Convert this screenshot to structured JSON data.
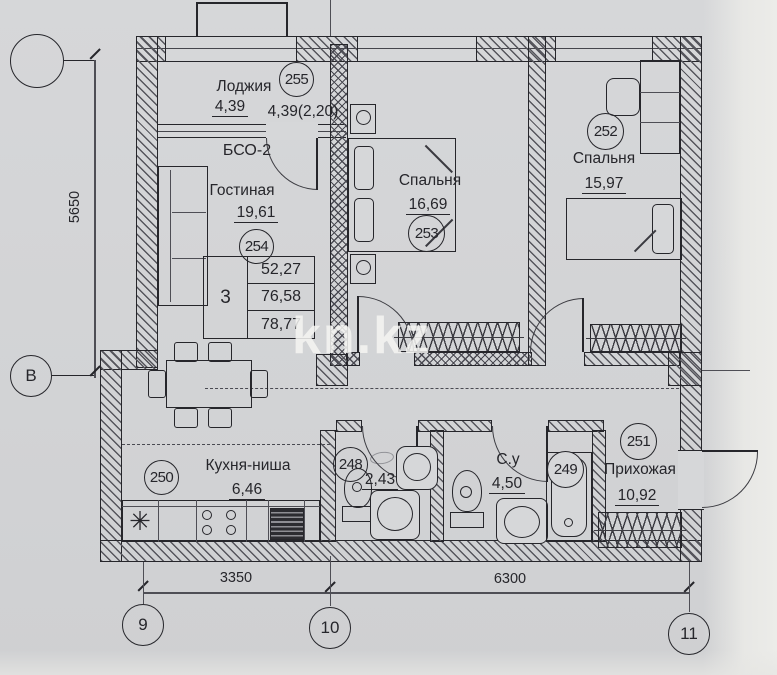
{
  "watermark": "kn.kz",
  "axes": {
    "b": "В",
    "c9": "9",
    "c10": "10",
    "c11": "11"
  },
  "dims": {
    "v": "5650",
    "b1": "3350",
    "b2": "6300"
  },
  "rooms": {
    "loggia": {
      "name": "Лоджия",
      "area": "4,39",
      "badge": "255",
      "area_full": "4,39(2,20)"
    },
    "bso": {
      "name": "БСО-2"
    },
    "living": {
      "name": "Гостиная",
      "area": "19,61",
      "badge": "254"
    },
    "bed1": {
      "name": "Спальня",
      "area": "16,69",
      "badge": "253"
    },
    "bed2": {
      "name": "Спальня",
      "area": "15,97",
      "badge": "252"
    },
    "kitchen": {
      "name": "Кухня-ниша",
      "area": "6,46",
      "badge": "250"
    },
    "wc": {
      "area": "2,43",
      "badge": "248"
    },
    "bath": {
      "name": "С.у",
      "area": "4,50",
      "badge": "249"
    },
    "hall": {
      "name": "Прихожая",
      "area": "10,92",
      "badge": "251"
    }
  },
  "table": {
    "col1": "3",
    "r1": "52,27",
    "r2": "76,58",
    "r3": "78,77"
  },
  "icons": {
    "sink_star": "✳"
  }
}
